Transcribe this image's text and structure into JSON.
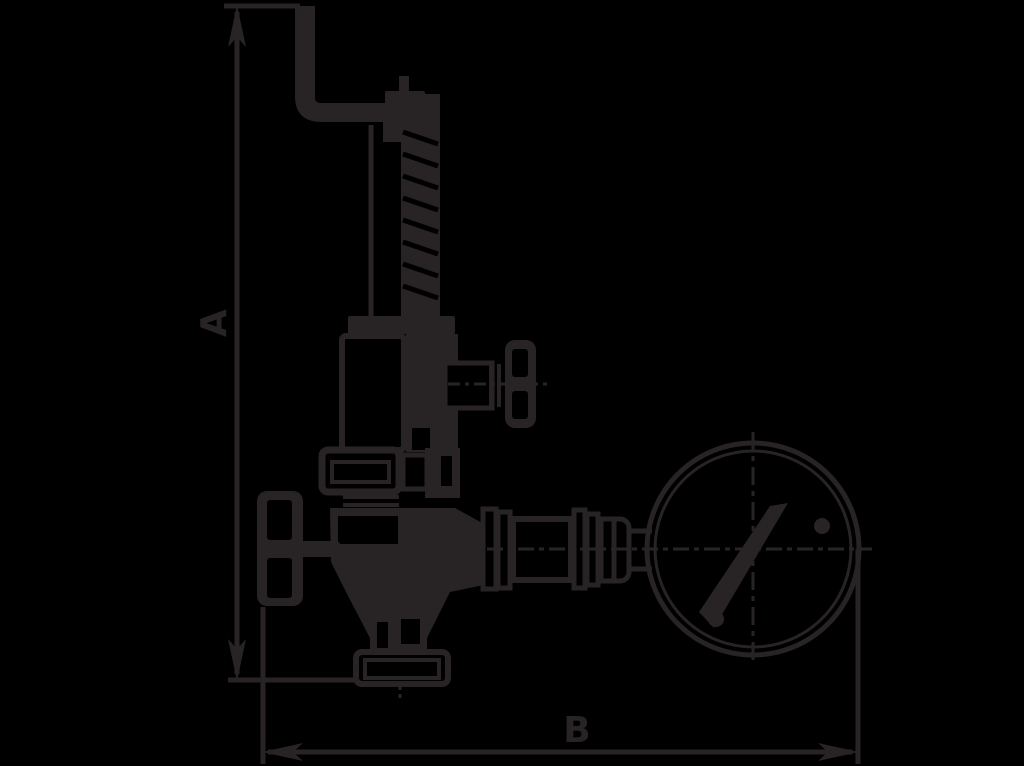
{
  "diagram": {
    "type": "technical-dimensional-drawing",
    "background_color": "#000000",
    "line_color": "#282425",
    "dimension_labels": {
      "height": {
        "label": "A"
      },
      "width": {
        "label": "B"
      }
    },
    "components": [
      "test-lever",
      "spring-spindle",
      "spring-housing",
      "side-outlet-handwheel",
      "valve-body",
      "inlet-handwheel",
      "inlet-flange",
      "gauge-connection-fittings",
      "pressure-gauge",
      "gauge-needle"
    ]
  }
}
